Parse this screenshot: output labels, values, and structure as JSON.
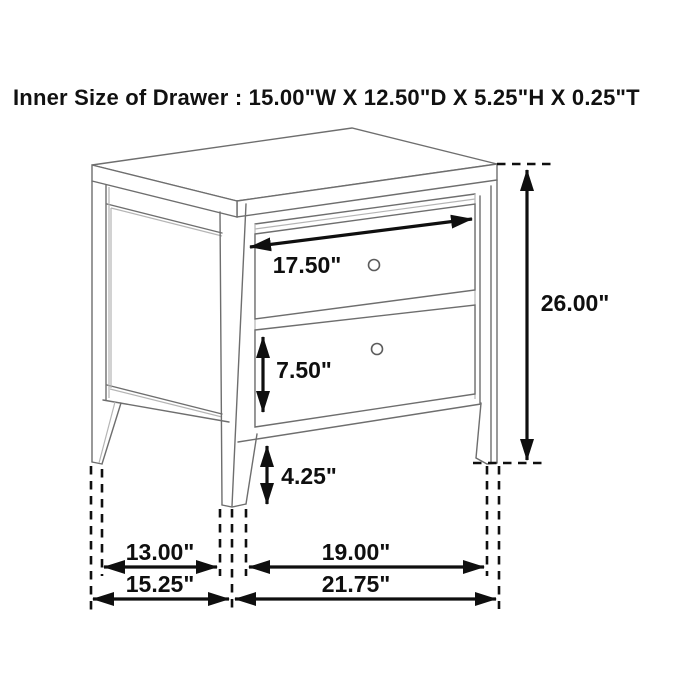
{
  "title": "Inner Size of Drawer : 15.00\"W X 12.50\"D X 5.25\"H X 0.25\"T",
  "drawer_inner_size": {
    "width": "15.00\"W",
    "depth": "12.50\"D",
    "height": "5.25\"H",
    "thickness": "0.25\"T"
  },
  "dimension_labels": {
    "top_drawer_width": "17.50\"",
    "bottom_drawer_height": "7.50\"",
    "leg_clearance": "4.25\"",
    "overall_height": "26.00\"",
    "side_span_inner": "13.00\"",
    "front_span_inner": "19.00\"",
    "side_depth_overall": "15.25\"",
    "front_width_overall": "21.75\""
  },
  "colors": {
    "background": "#ffffff",
    "furniture_line": "#6e6e6e",
    "furniture_line_light": "#b5b5b5",
    "dimension_ink": "#0f0f0f"
  }
}
